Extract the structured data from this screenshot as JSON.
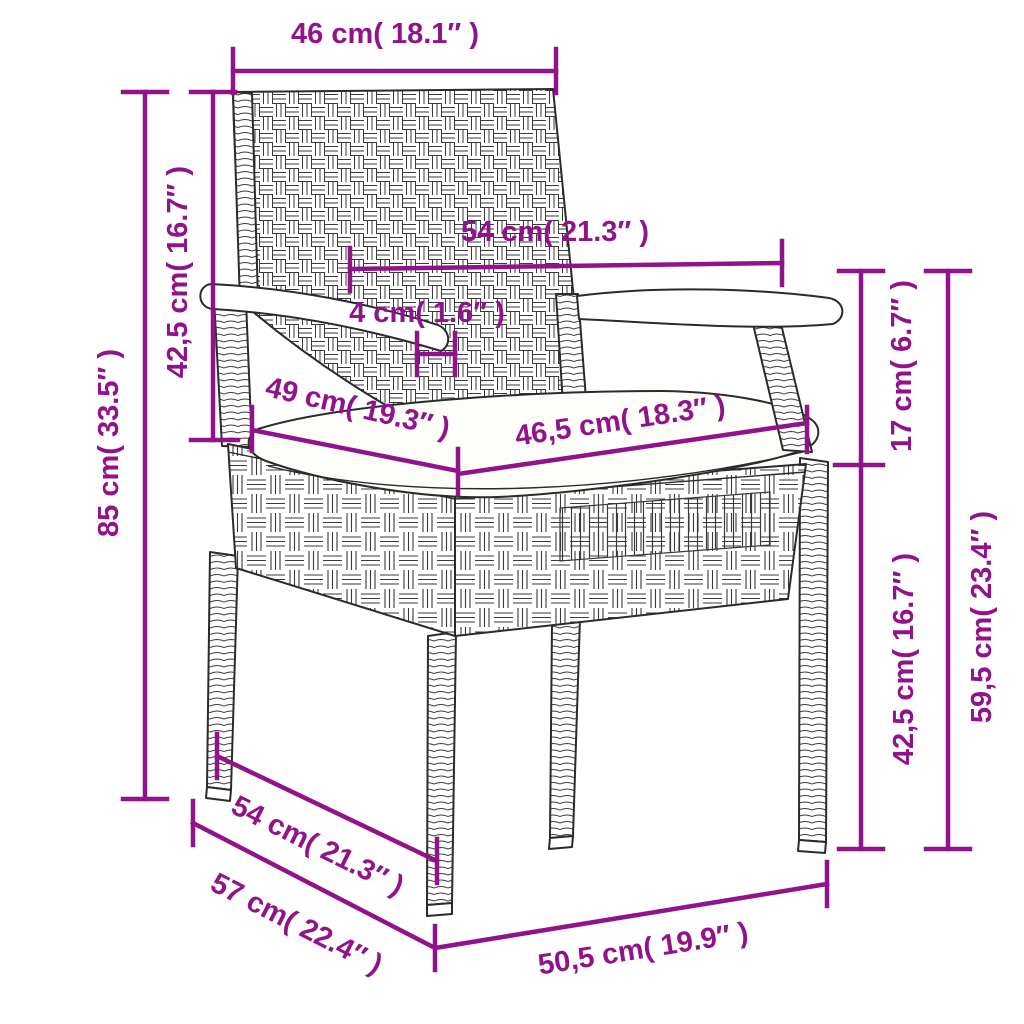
{
  "meta": {
    "accent_color": "#91138B",
    "drawing_line_color": "#2b2b2b",
    "background_color": "#ffffff",
    "subject": "rattan-garden-chair-dimension-diagram"
  },
  "dimensions": {
    "backrest_width": {
      "label": "46 cm( 18.1″ )"
    },
    "total_height": {
      "label": "85 cm( 33.5″ )"
    },
    "backrest_height": {
      "label": "42,5 cm( 16.7″ )"
    },
    "armrest_span": {
      "label": "54 cm( 21.3″ )"
    },
    "armrest_thickness": {
      "label": "4 cm( 1.6″ )"
    },
    "seat_depth": {
      "label": "49 cm( 19.3″ )"
    },
    "seat_width": {
      "label": "46,5 cm( 18.3″ )"
    },
    "armrest_above_seat": {
      "label": "17 cm( 6.7″ )"
    },
    "seat_height": {
      "label": "42,5 cm( 16.7″ )"
    },
    "armrest_total_height": {
      "label": "59,5 cm( 23.4″ )"
    },
    "depth_upper": {
      "label": "54 cm( 21.3″ )"
    },
    "depth_total": {
      "label": "57 cm( 22.4″ )"
    },
    "base_width": {
      "label": "50,5 cm( 19.9″ )"
    }
  }
}
